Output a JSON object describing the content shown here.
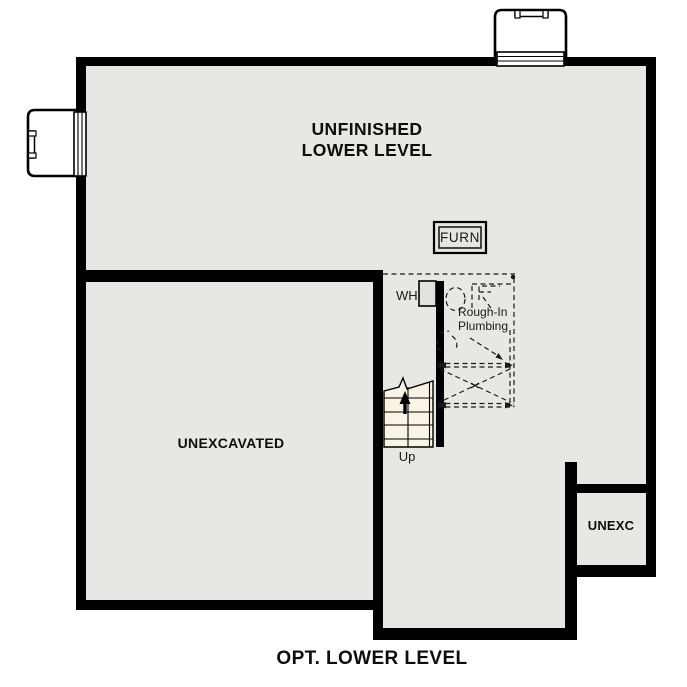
{
  "plan": {
    "main_room": {
      "label_line1": "UNFINISHED",
      "label_line2": "LOWER LEVEL"
    },
    "unexcavated": {
      "label": "UNEXCAVATED"
    },
    "unexc": {
      "label": "UNEXC"
    },
    "furnace": {
      "label": "FURN"
    },
    "water_heater": {
      "label": "WH"
    },
    "rough_in_plumbing": {
      "label_line1": "Rough-In",
      "label_line2": "Plumbing"
    },
    "stairs": {
      "label": "Up"
    }
  },
  "title": "OPT. LOWER LEVEL",
  "colors": {
    "wall": "#000000",
    "floor": "#e8e7e4",
    "stair_fill": "#f9f4e3",
    "background": "#ffffff",
    "fixture_line": "#1a1a1a"
  }
}
